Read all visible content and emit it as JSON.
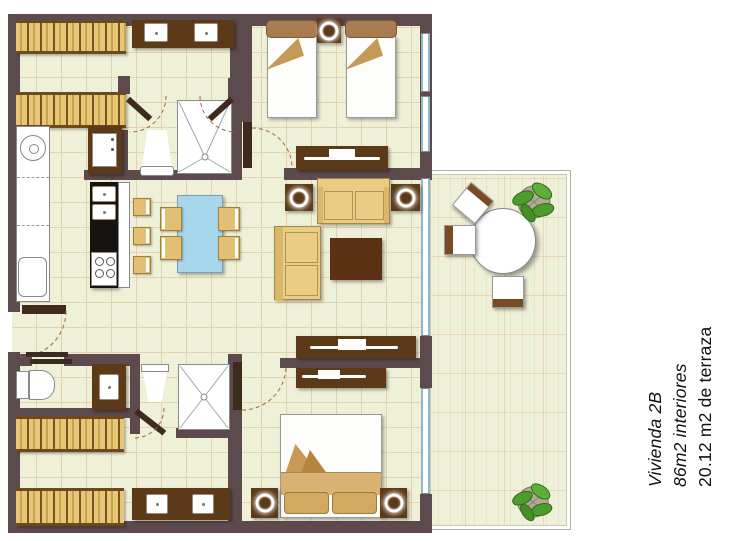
{
  "caption": {
    "line1": "Vivienda 2B",
    "line2": "86m2 interiores",
    "line3": "20.12 m2 de terraza"
  },
  "palette": {
    "wall": "#5d4a4c",
    "floor": "#eef0d7",
    "wood_dark": "#5c3a18",
    "wood_mid": "#a87c4e",
    "tan": "#e3bf73",
    "sofa_tan": "#e9cd85",
    "table_blue": "#a7d7ed",
    "plant_green": "#4f9c2e",
    "glass_blue": "#8fb8cc",
    "grid_line": "#e3d2ae"
  }
}
